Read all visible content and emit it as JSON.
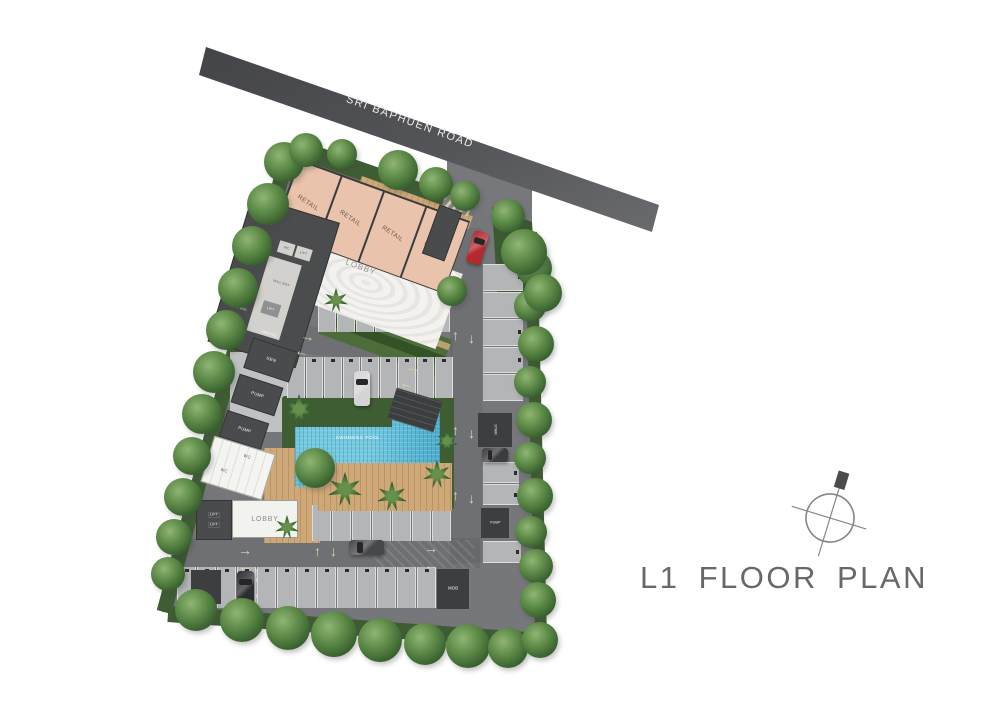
{
  "title": {
    "label": "L1 FLOOR PLAN"
  },
  "road": {
    "label": "SRI BAPHUEN ROAD"
  },
  "plan": {
    "retail_units": [
      "RETAIL",
      "RETAIL",
      "RETAIL",
      "RETAIL"
    ],
    "main_lobby": "LOBBY",
    "stair_top": "STAIR",
    "wc_top": "WC",
    "lift_top": "LIFT",
    "mdb_top": "MDB",
    "mail_box": "MAIL BOX",
    "lift_core": "LIFT",
    "control_room": "CONTROL",
    "service_room": "SERVICE",
    "gen_room": "GEN",
    "pump_room_1": "PUMP",
    "pump_room_2": "PUMP",
    "wc_block": [
      "WC",
      "WC"
    ],
    "residential_lobby": "LOBBY",
    "lift_block": [
      "LIFT",
      "LIFT"
    ],
    "stair_right": "STAIR",
    "pump_right": "PUMP",
    "mdb_parking": "MDB",
    "swimming_pool": "SWIMMING POOL"
  },
  "icons": {
    "arrow_up": "↑",
    "arrow_down": "↓",
    "arrow_left": "←",
    "arrow_right": "→",
    "compass": "compass-north-icon"
  },
  "colors": {
    "road": "#515255",
    "paving": "#76777a",
    "retail": "#e9c3ab",
    "pool": "#58b6d3",
    "wood": "#cfa878",
    "grass": "#3f5d33",
    "tree": "#4c7a3c",
    "arrow": "#ddd6ab",
    "car_red": "#b5282c",
    "title_text": "#67686a"
  }
}
